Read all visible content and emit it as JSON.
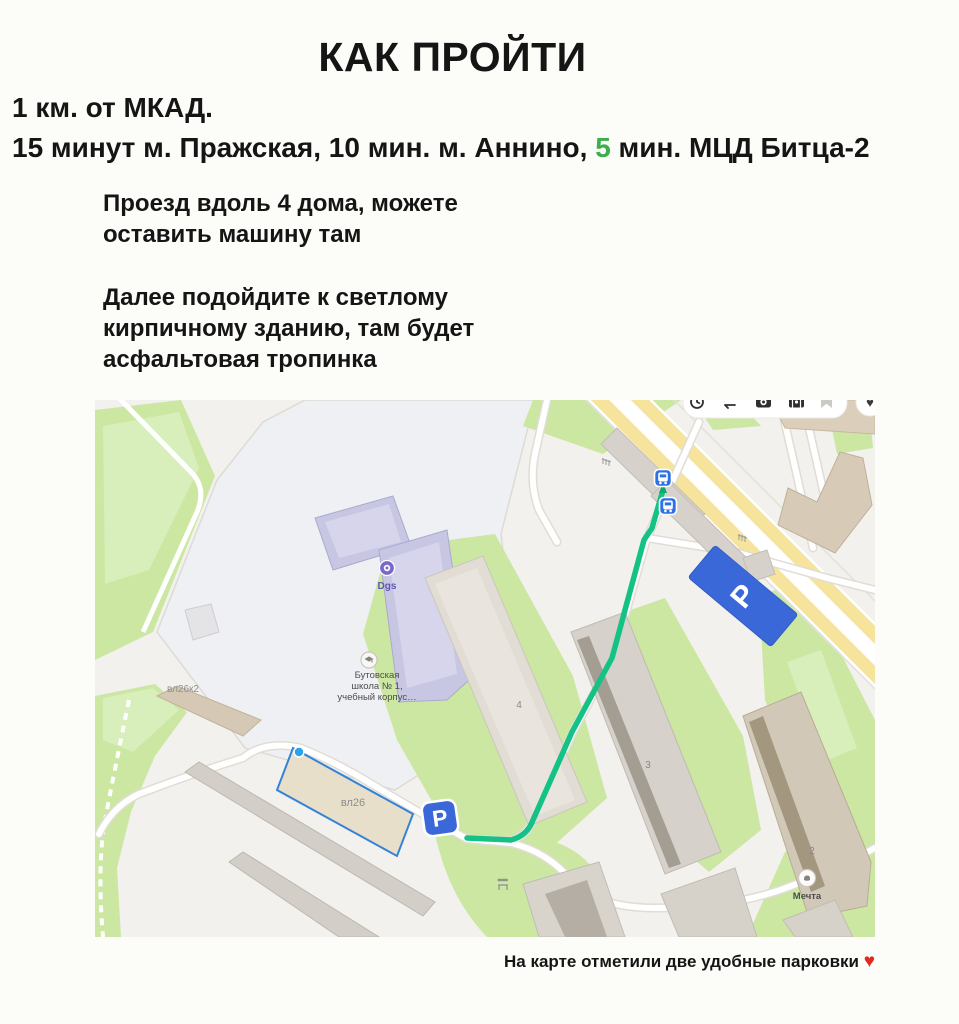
{
  "theme": {
    "accent-green": "#3cae4a",
    "heart-red": "#e3291d",
    "route-green": "#15c286",
    "parking-blue": "#3a68d8",
    "transit-blue": "#2e71e5",
    "selected-blue": "#3583d6",
    "origin-dot-blue": "#2ba3e8",
    "road-yellow": "#f6e49c",
    "park-green": "#cbe7a2",
    "map-bg": "#f2f1ee"
  },
  "header": {
    "title": "КАК ПРОЙТИ"
  },
  "intro": {
    "line1": "1 км. от МКАД.",
    "line2_prefix": "15 минут м. Пражская, 10 мин. м. Аннино, ",
    "line2_highlight": "5",
    "line2_suffix": " мин. МЦД Битца-2"
  },
  "steps": [
    {
      "lines": [
        "Проезд вдоль 4 дома, можете",
        "оставить машину там"
      ]
    },
    {
      "lines": [
        "Далее подойдите к светлому",
        "кирпичному зданию, там будет",
        "асфальтовая тропинка"
      ]
    }
  ],
  "map": {
    "toolbar_icons": [
      "clock-icon",
      "sync-arrows-icon",
      "camera-icon",
      "panorama-icon",
      "bookmark-icon",
      "favorites-heart-icon"
    ],
    "toolbar_heart_glyph": "♥",
    "labels": {
      "parking_letter": "P",
      "vl26k2": "вл26к2",
      "vl26": "вл26",
      "b4": "4",
      "b3": "3",
      "b2": "2",
      "school_l1": "Бутовская",
      "school_l2": "школа № 1,",
      "school_l3": "учебный корпус…",
      "dgs": "Dgs",
      "mechta": "Мечта"
    }
  },
  "caption": {
    "text": "На карте отметили две удобные парковки",
    "heart": "♥"
  }
}
